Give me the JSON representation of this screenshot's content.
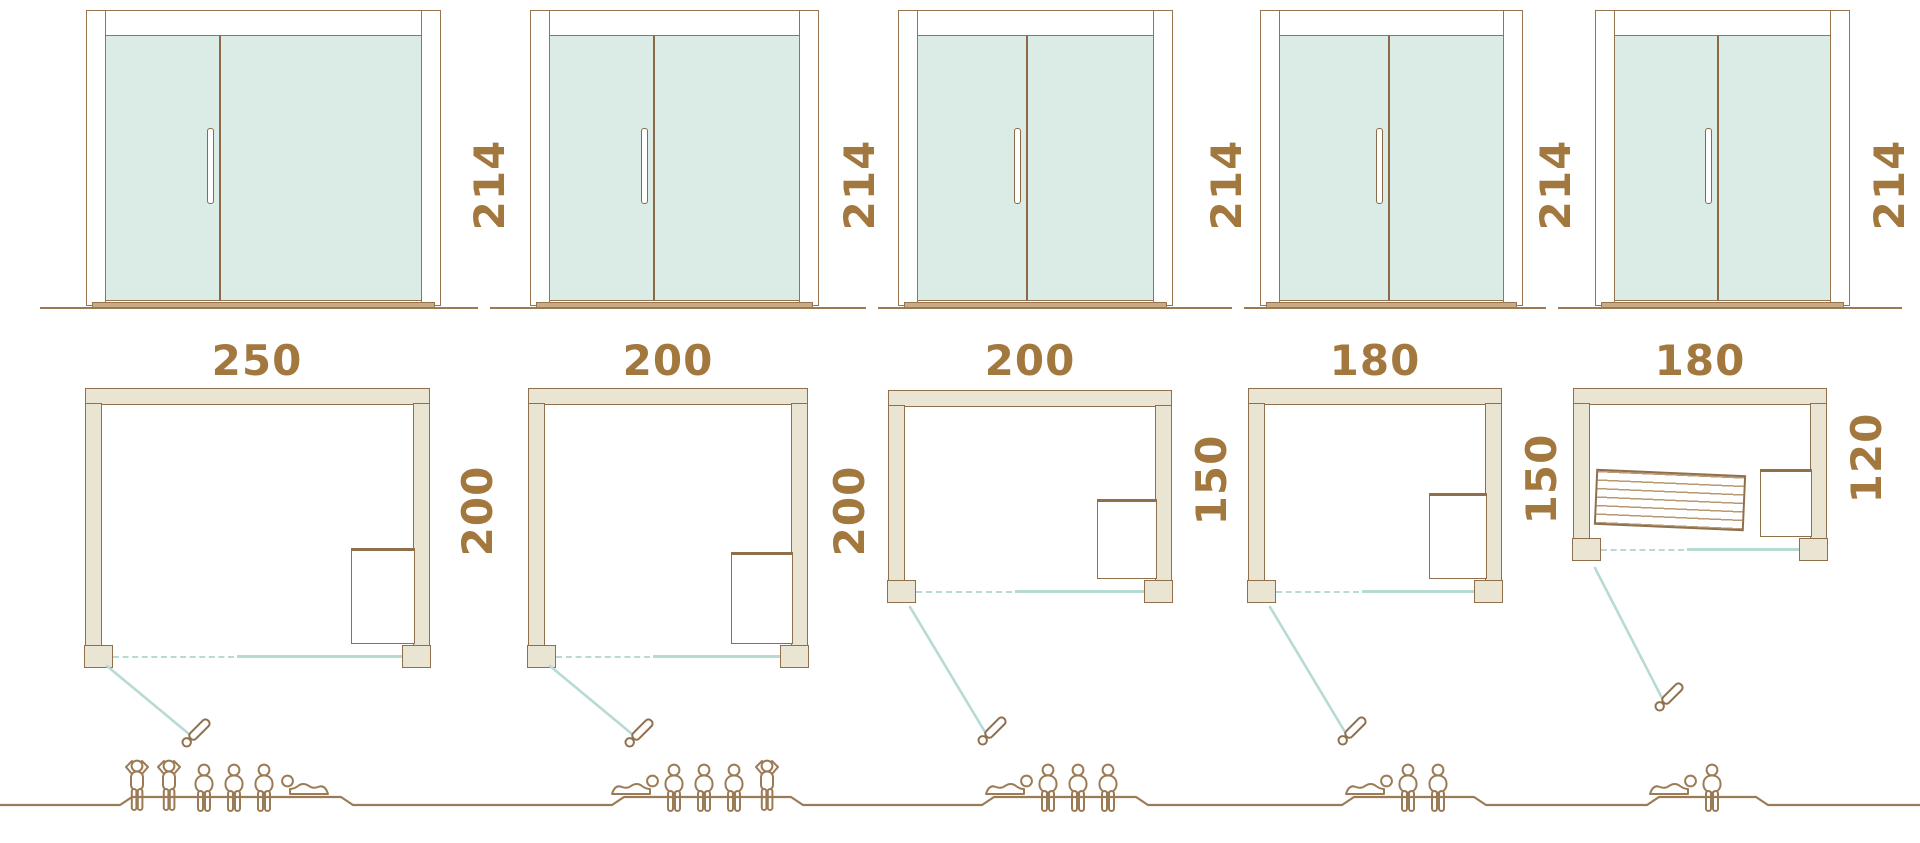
{
  "diagram_type": "sauna-size-comparison-drawing",
  "saunas": [
    {
      "door_height": "214",
      "width": "250",
      "depth": "200",
      "people": {
        "standing": 2,
        "sitting": 3,
        "lying": 1,
        "total": 6
      }
    },
    {
      "door_height": "214",
      "width": "200",
      "depth": "200",
      "people": {
        "standing": 1,
        "sitting": 3,
        "lying": 1,
        "total": 5
      }
    },
    {
      "door_height": "214",
      "width": "200",
      "depth": "150",
      "people": {
        "standing": 0,
        "sitting": 3,
        "lying": 1,
        "total": 4
      }
    },
    {
      "door_height": "214",
      "width": "180",
      "depth": "150",
      "people": {
        "standing": 0,
        "sitting": 2,
        "lying": 1,
        "total": 3
      }
    },
    {
      "door_height": "214",
      "width": "180",
      "depth": "120",
      "people": {
        "standing": 0,
        "sitting": 1,
        "lying": 1,
        "total": 2
      }
    }
  ],
  "colors": {
    "outline_brown": "#96754e",
    "slat_light_brown": "#c0a179",
    "label_brown": "#a2783e",
    "wall_fill_beige": "#e9e5d2",
    "glass_mint": "#dbebe6",
    "swing_teal": "#b7dad5"
  },
  "icons": {
    "heater": "crosshatch-lattice-box",
    "door_swing_leaf": "rounded-bar-with-knob",
    "person_standing": "outline-human-standing",
    "person_sitting": "outline-human-sitting",
    "person_lying": "outline-human-reclining"
  }
}
